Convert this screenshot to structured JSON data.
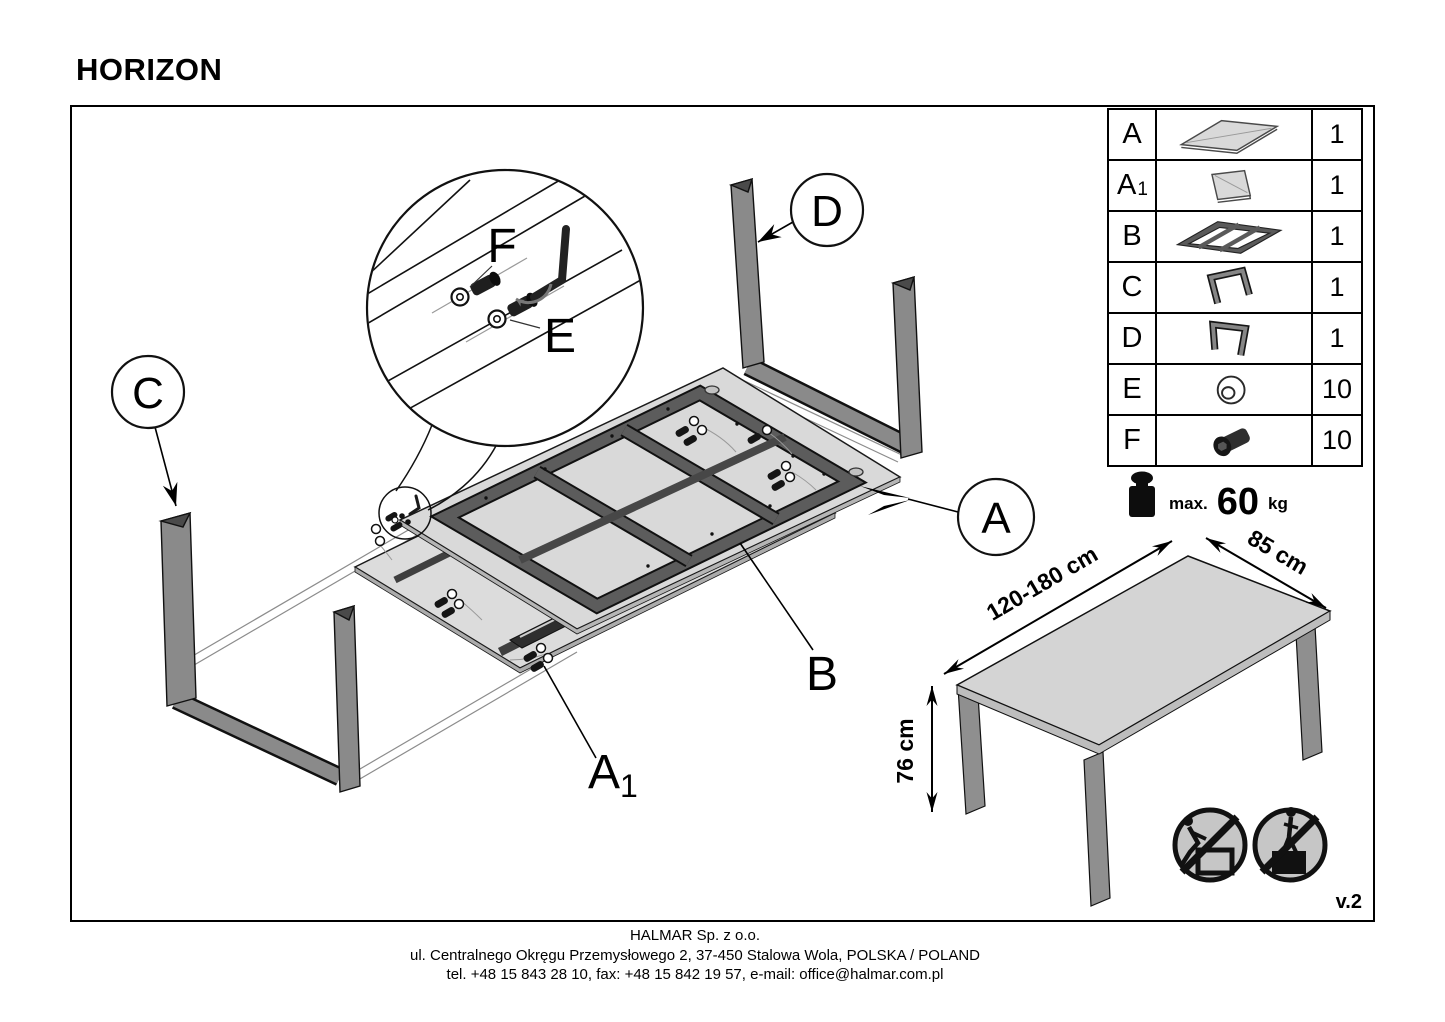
{
  "title": "HORIZON",
  "version_label": "v.2",
  "parts_table": {
    "rows": [
      {
        "id": "A",
        "sub": "",
        "qty": "1",
        "icon": "tabletop-panel"
      },
      {
        "id": "A",
        "sub": "1",
        "qty": "1",
        "icon": "extension-panel"
      },
      {
        "id": "B",
        "sub": "",
        "qty": "1",
        "icon": "support-frame"
      },
      {
        "id": "C",
        "sub": "",
        "qty": "1",
        "icon": "u-shaped-leg"
      },
      {
        "id": "D",
        "sub": "",
        "qty": "1",
        "icon": "u-shaped-leg"
      },
      {
        "id": "E",
        "sub": "",
        "qty": "10",
        "icon": "washer"
      },
      {
        "id": "F",
        "sub": "",
        "qty": "10",
        "icon": "bolt"
      }
    ]
  },
  "weight_limit": {
    "label": "max.",
    "value": "60",
    "unit": "kg"
  },
  "dimensions": {
    "length": "120-180 cm",
    "depth": "85 cm",
    "height": "76 cm"
  },
  "callouts": {
    "a": "A",
    "a1_base": "A",
    "a1_sub": "1",
    "b": "B",
    "c": "C",
    "d": "D",
    "e": "E",
    "f": "F"
  },
  "footer": {
    "company": "HALMAR Sp. z o.o.",
    "address": "ul. Centralnego Okręgu Przemysłowego 2, 37-450 Stalowa Wola, POLSKA / POLAND",
    "contacts": "tel. +48 15 843 28 10, fax: +48 15 842 19 57, e-mail: office@halmar.com.pl"
  },
  "colors": {
    "line": "#000000",
    "panel_fill": "#d9d9d9",
    "panel_edge": "#b5b5b5",
    "metal_gray": "#8a8a8a",
    "frame_dark": "#5c5c5c",
    "hardware_dark": "#1f1f1f",
    "sign_fill": "#c6c6c6"
  }
}
